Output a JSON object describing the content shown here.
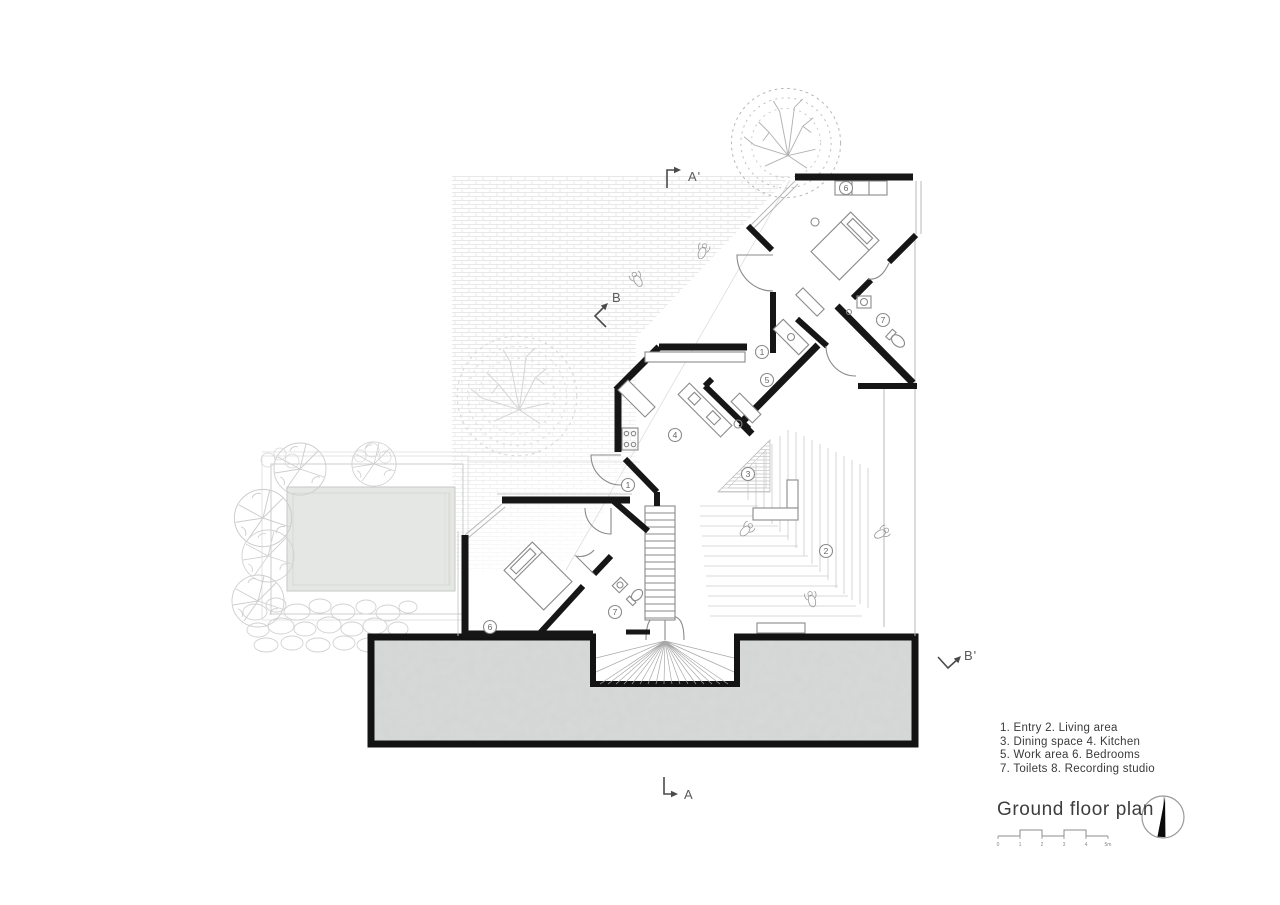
{
  "sheet": {
    "title": "Ground floor plan",
    "legend": {
      "lines": [
        "1. Entry 2. Living area",
        "3. Dining space 4. Kitchen",
        "5. Work area 6. Bedrooms",
        "7. Toilets 8. Recording studio"
      ]
    },
    "section_markers": {
      "a_top": "A'",
      "a_bottom": "A",
      "b_upper": "B",
      "b_lower": "B'"
    },
    "room_markers": [
      {
        "label": "6",
        "room": "bedroom-upper"
      },
      {
        "label": "7",
        "room": "toilet-upper"
      },
      {
        "label": "1",
        "room": "entry"
      },
      {
        "label": "5",
        "room": "work-area"
      },
      {
        "label": "4",
        "room": "kitchen"
      },
      {
        "label": "3",
        "room": "dining-space"
      },
      {
        "label": "2",
        "room": "living-area"
      },
      {
        "label": "1",
        "room": "entry-lower"
      },
      {
        "label": "6",
        "room": "bedroom-lower"
      },
      {
        "label": "7",
        "room": "toilet-lower"
      }
    ],
    "scale_bar": {
      "labels": [
        "0",
        "1",
        "2",
        "3",
        "4",
        "5m"
      ]
    },
    "colors": {
      "wall": "#161616",
      "slab_fill": "#d7dad8",
      "pool_fill": "#e5e7e4",
      "sketch_line": "#c9c9c9",
      "text": "#3a3a3a"
    }
  }
}
